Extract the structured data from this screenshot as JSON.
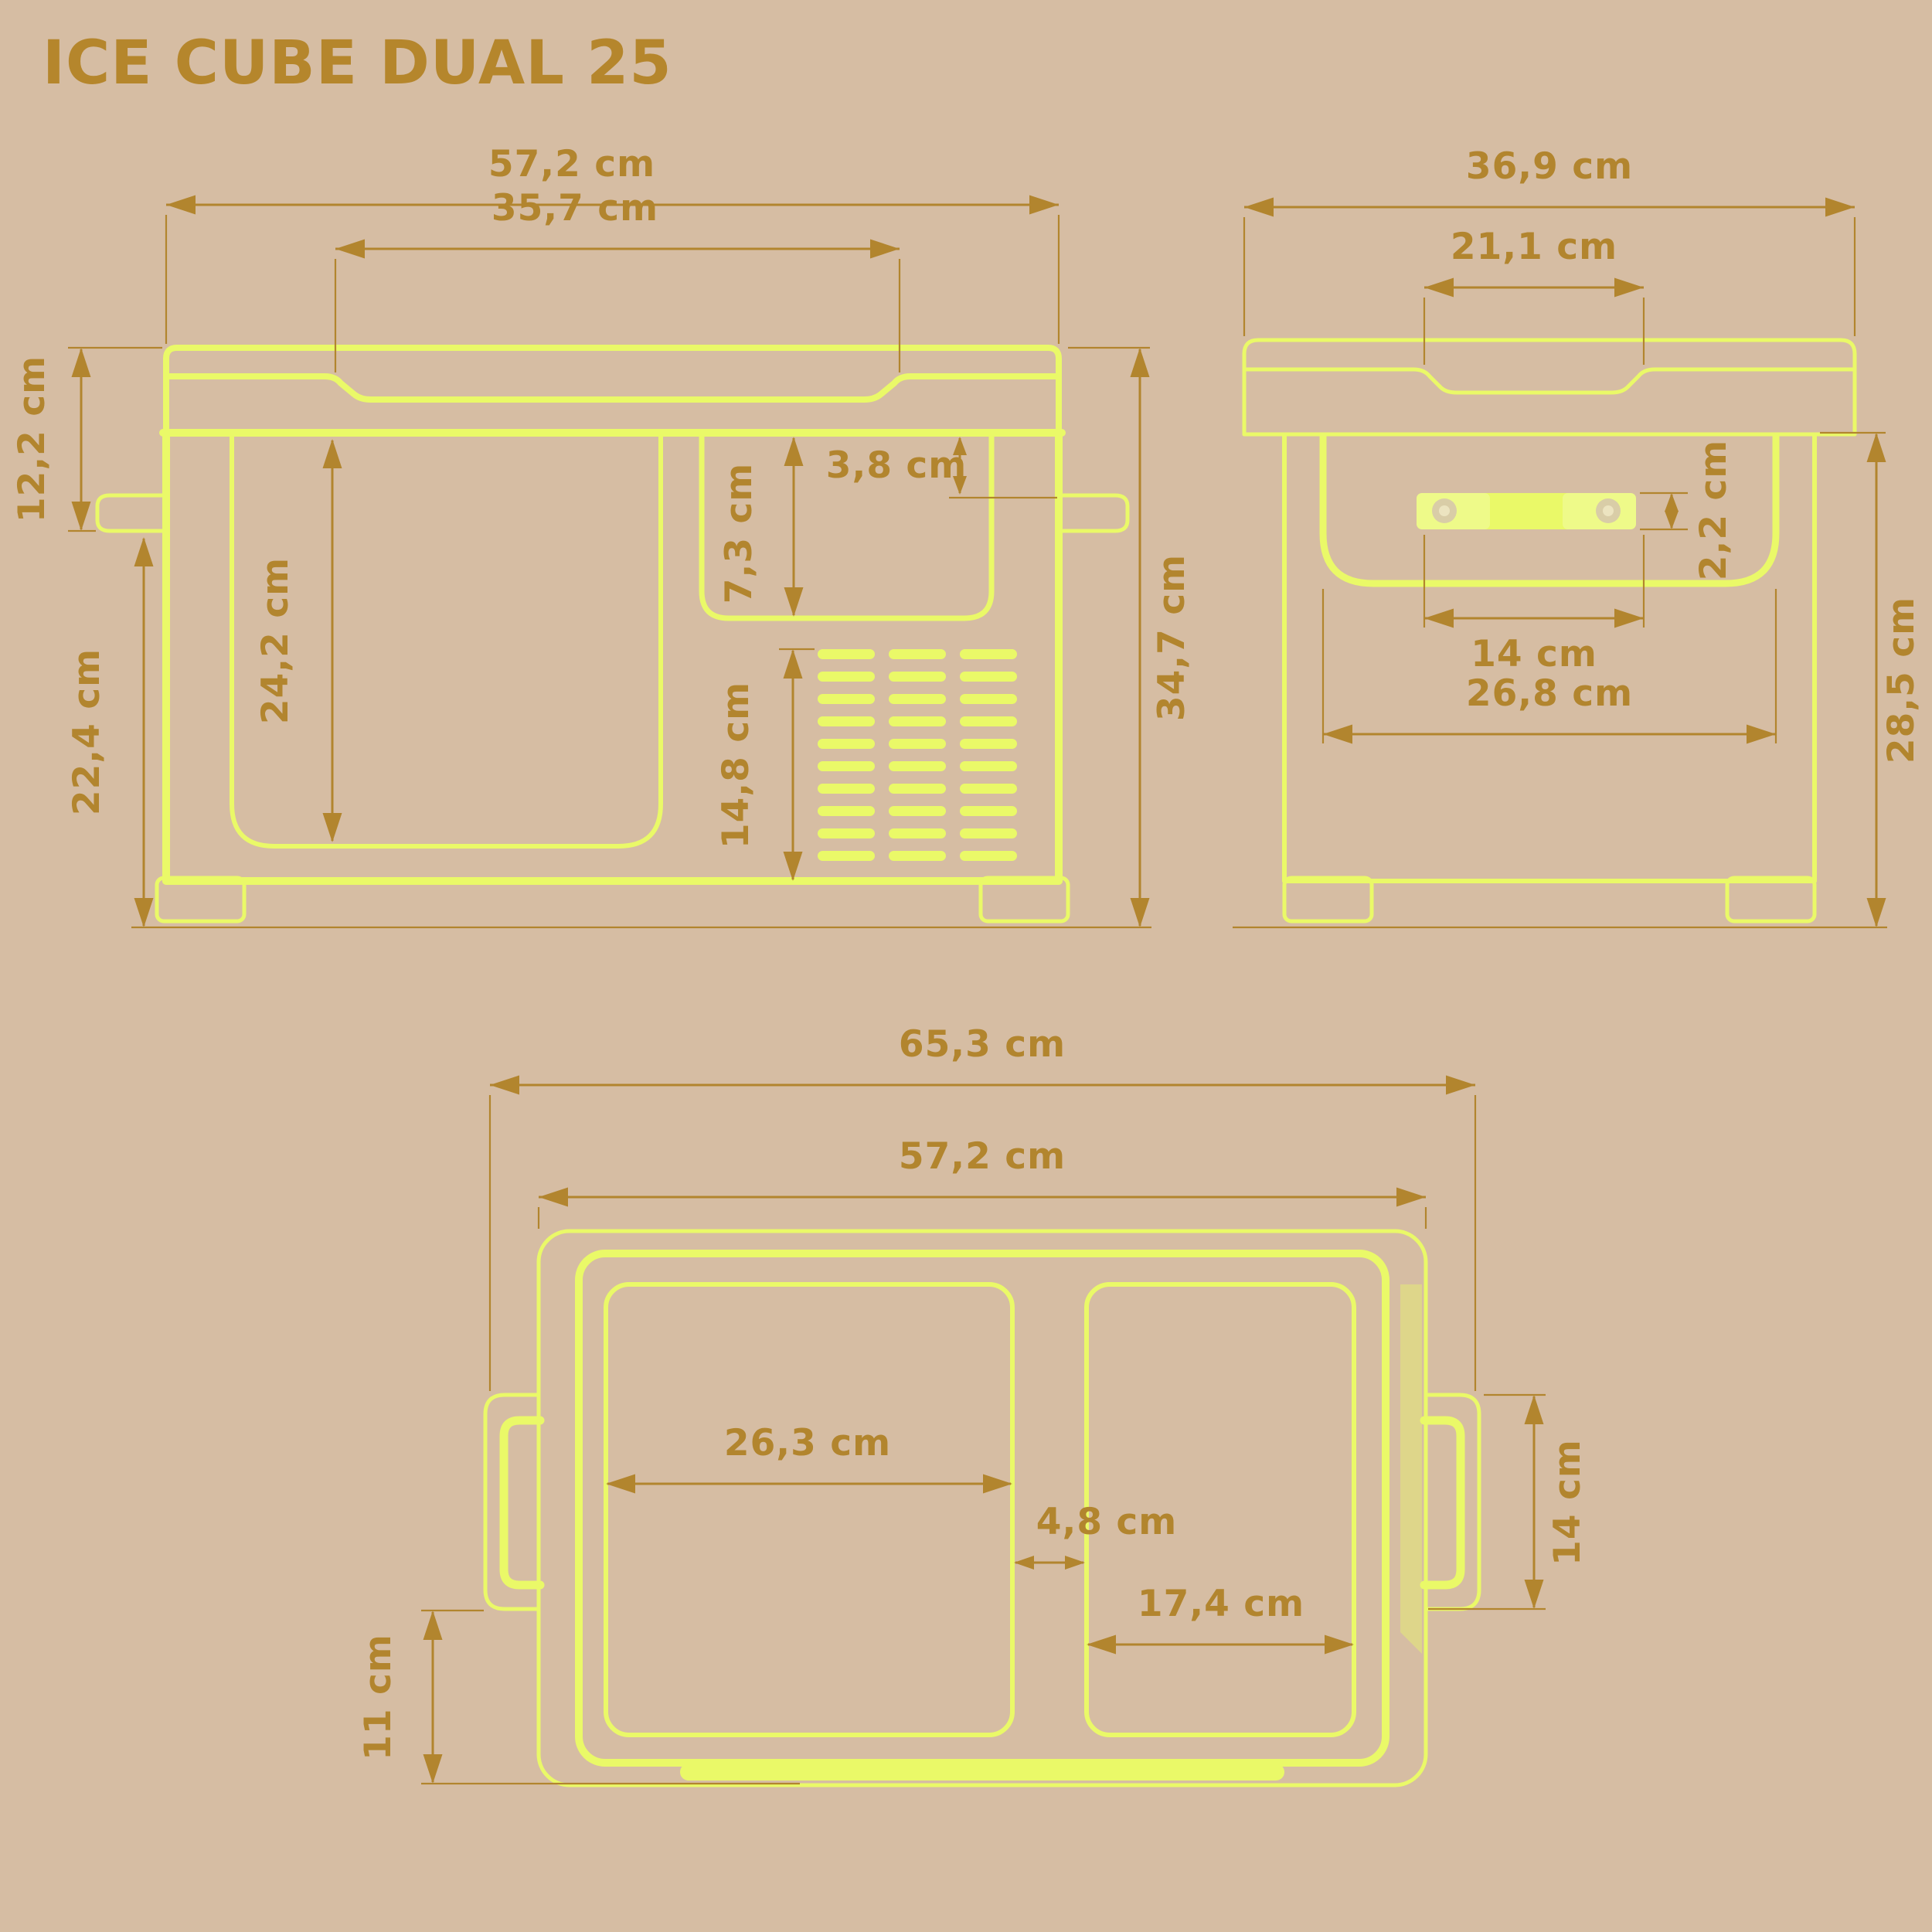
{
  "title": "ICE CUBE DUAL 25",
  "product": "portable dual-zone cooler dimension diagram",
  "units": "cm",
  "colors": {
    "background": "#d6bda3",
    "line_art": "#eaf968",
    "line_art_tint": "rgba(234,249,104,0.42)",
    "dimension_gold": "#b2852e",
    "title_gold": "#b5862c",
    "screw_outer": "#d9cda7",
    "screw_inner": "#ece4c0"
  },
  "views": {
    "front": {
      "name": "front view",
      "dims": {
        "outer_width": "57,2 cm",
        "lid_recess_width": "35,7 cm",
        "lid_height": "12,2 cm",
        "lower_body_height": "22,4 cm",
        "door_panel_height": "24,2 cm",
        "pocket_depth": "7,3 cm",
        "handle_offset": "3,8 cm",
        "vent_height": "14,8 cm",
        "total_height": "34,7 cm"
      },
      "features": [
        "lid with recess",
        "left handle",
        "right handle",
        "door panel",
        "latch pocket",
        "vent grille 3x10",
        "two feet"
      ]
    },
    "side": {
      "name": "side view",
      "dims": {
        "outer_depth": "36,9 cm",
        "lid_recess_depth": "21,1 cm",
        "handle_bar_height": "2,2 cm",
        "handle_bar_length": "14 cm",
        "panel_width": "26,8 cm",
        "body_height": "28,5 cm"
      },
      "features": [
        "lid with recess",
        "solid handle bar with two screws",
        "rounded panel",
        "two feet"
      ]
    },
    "top": {
      "name": "top view",
      "dims": {
        "outer_width_with_handles": "65,3 cm",
        "body_width": "57,2 cm",
        "left_lid_width": "26,3 cm",
        "lid_gap": "4,8 cm",
        "right_lid_width": "17,4 cm",
        "handle_length": "14 cm",
        "rear_offset": "11 cm"
      },
      "features": [
        "outer shell",
        "inner lid frame",
        "left compartment lid",
        "right compartment lid",
        "left handle",
        "right handle",
        "hinge strip",
        "tinted edge band"
      ]
    }
  }
}
